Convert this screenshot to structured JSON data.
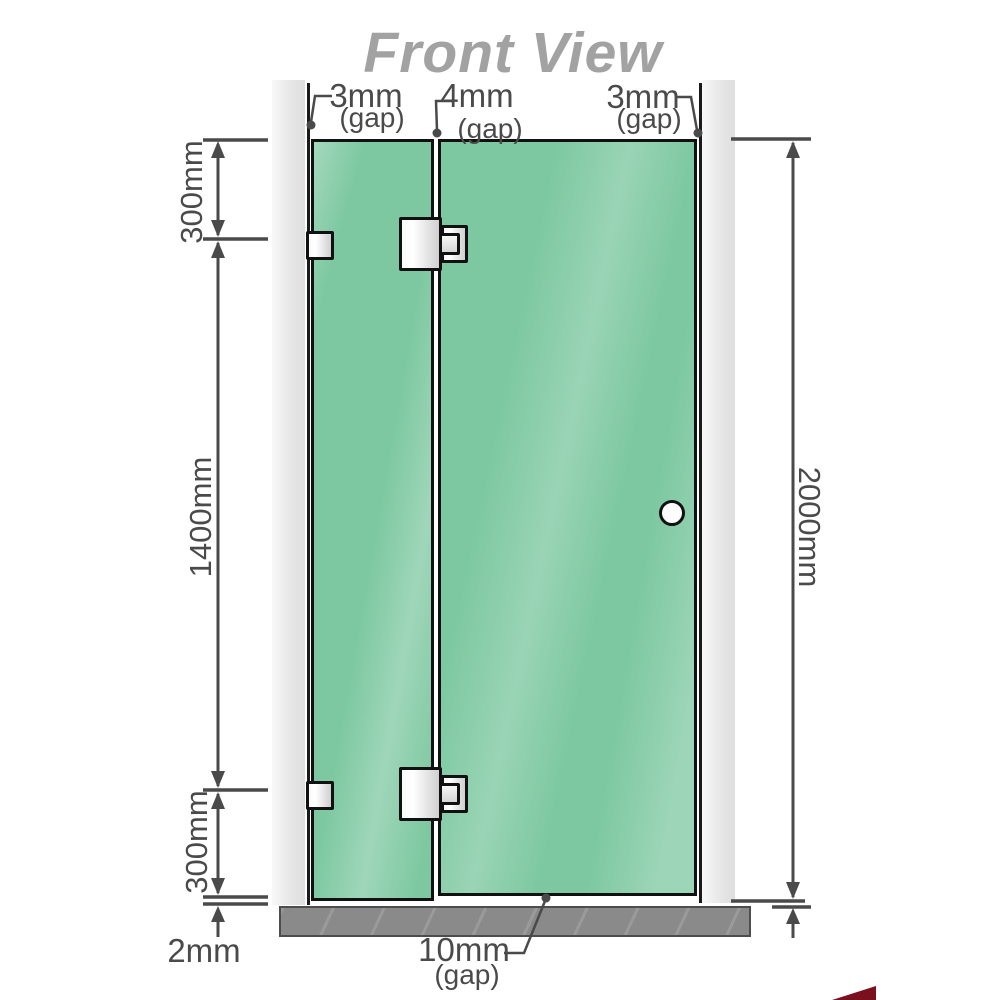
{
  "title": "Front View",
  "colors": {
    "glass": "#7dc8a1",
    "glass-border": "#111111",
    "wall": "#e7e7e7",
    "floor": "#8a8a8a",
    "line": "#4a4a4a",
    "title-color": "#a2a2a2",
    "metal-light": "#fafafa",
    "metal-dark": "#cfcfcf",
    "watermark": "#7a0f1d"
  },
  "top_gaps": {
    "left": {
      "value": "3mm",
      "suffix": "(gap)"
    },
    "middle": {
      "value": "4mm",
      "suffix": "(gap)"
    },
    "right": {
      "value": "3mm",
      "suffix": "(gap)"
    }
  },
  "left_dims": {
    "top": "300mm",
    "middle": "1400mm",
    "bottom": "300mm"
  },
  "right_dim": {
    "height": "2000mm"
  },
  "bottom_dims": {
    "floor_gap": "2mm",
    "door_gap": {
      "value": "10mm",
      "suffix": "(gap)"
    }
  }
}
